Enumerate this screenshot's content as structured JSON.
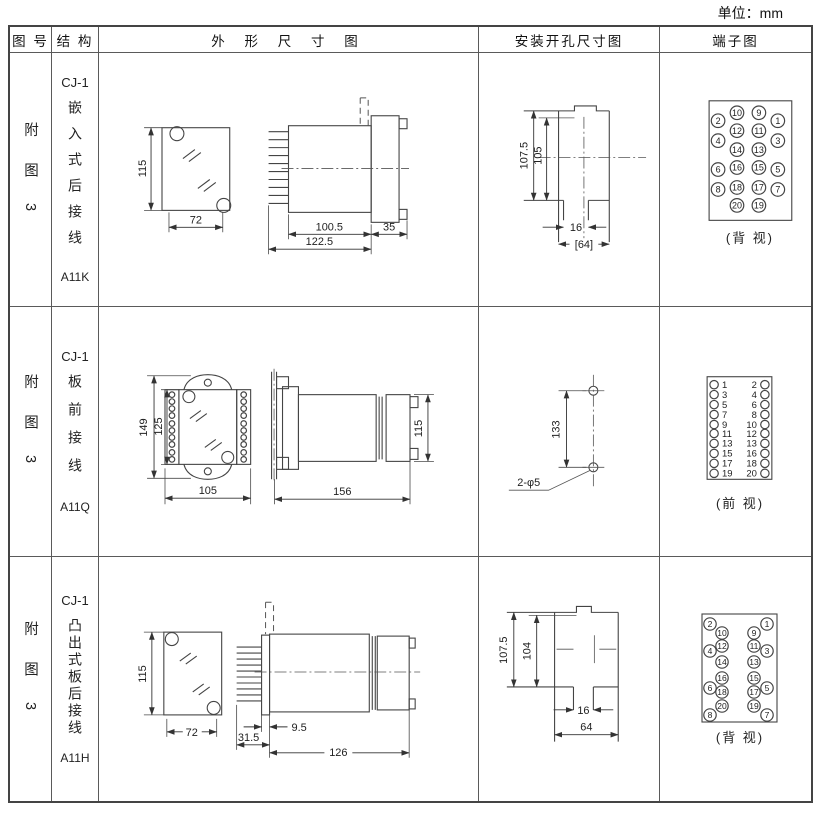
{
  "unit_label": "单位：mm",
  "headers": {
    "figure": "图 号",
    "structure": "结 构",
    "outline": "外 形 尺 寸 图",
    "install": "安装开孔尺寸图",
    "terminal": "端子图"
  },
  "rows": [
    {
      "figure": "附图3",
      "model": "CJ-1",
      "mounting": "嵌入式后接线",
      "code": "A11K",
      "outline": {
        "height": "115",
        "width": "72",
        "d1": "100.5",
        "d2": "122.5",
        "d3": "35"
      },
      "install": {
        "v1": "107.5",
        "v2": "105",
        "notch": "16",
        "span": "[64]"
      },
      "terminal": {
        "view": "(背 视)"
      }
    },
    {
      "figure": "附图3",
      "model": "CJ-1",
      "mounting": "板前接线",
      "code": "A11Q",
      "outline": {
        "h1": "149",
        "h2": "125",
        "width": "105",
        "length": "156",
        "rear_h": "115"
      },
      "install": {
        "span": "133",
        "holes": "2-φ5"
      },
      "terminal": {
        "view": "(前 视)"
      }
    },
    {
      "figure": "附图3",
      "model": "CJ-1",
      "mounting": "凸出式板后接线",
      "code": "A11H",
      "outline": {
        "height": "115",
        "width": "72",
        "d1": "9.5",
        "d2": "31.5",
        "d3": "126"
      },
      "install": {
        "v1": "107.5",
        "v2": "104",
        "notch": "16",
        "span": "64"
      },
      "terminal": {
        "view": "(背 视)"
      }
    }
  ],
  "terminals": {
    "a11k": {
      "r": 6.8,
      "font": 9,
      "dy": 3.2,
      "items": [
        {
          "n": "10",
          "cx": 77,
          "cy": 60
        },
        {
          "n": "9",
          "cx": 99,
          "cy": 60
        },
        {
          "n": "2",
          "cx": 58,
          "cy": 68
        },
        {
          "n": "1",
          "cx": 118,
          "cy": 68
        },
        {
          "n": "12",
          "cx": 77,
          "cy": 78
        },
        {
          "n": "11",
          "cx": 99,
          "cy": 78
        },
        {
          "n": "4",
          "cx": 58,
          "cy": 88
        },
        {
          "n": "3",
          "cx": 118,
          "cy": 88
        },
        {
          "n": "14",
          "cx": 77,
          "cy": 97
        },
        {
          "n": "13",
          "cx": 99,
          "cy": 97
        },
        {
          "n": "16",
          "cx": 77,
          "cy": 115
        },
        {
          "n": "15",
          "cx": 99,
          "cy": 115
        },
        {
          "n": "6",
          "cx": 58,
          "cy": 117
        },
        {
          "n": "5",
          "cx": 118,
          "cy": 117
        },
        {
          "n": "18",
          "cx": 77,
          "cy": 135
        },
        {
          "n": "17",
          "cx": 99,
          "cy": 135
        },
        {
          "n": "8",
          "cx": 58,
          "cy": 137
        },
        {
          "n": "7",
          "cx": 118,
          "cy": 137
        },
        {
          "n": "20",
          "cx": 77,
          "cy": 153
        },
        {
          "n": "19",
          "cx": 99,
          "cy": 153
        }
      ]
    },
    "a11q": {
      "r": 4.2,
      "font": 9.5,
      "dy": 3.3,
      "items": [
        {
          "n": "1",
          "cx": 54,
          "cy": 78,
          "tx": 62,
          "anchor": "start"
        },
        {
          "n": "2",
          "cx": 105,
          "cy": 78,
          "tx": 97,
          "anchor": "end"
        },
        {
          "n": "3",
          "cx": 54,
          "cy": 88,
          "tx": 62,
          "anchor": "start"
        },
        {
          "n": "4",
          "cx": 105,
          "cy": 88,
          "tx": 97,
          "anchor": "end"
        },
        {
          "n": "5",
          "cx": 54,
          "cy": 98,
          "tx": 62,
          "anchor": "start"
        },
        {
          "n": "6",
          "cx": 105,
          "cy": 98,
          "tx": 97,
          "anchor": "end"
        },
        {
          "n": "7",
          "cx": 54,
          "cy": 108,
          "tx": 62,
          "anchor": "start"
        },
        {
          "n": "8",
          "cx": 105,
          "cy": 108,
          "tx": 97,
          "anchor": "end"
        },
        {
          "n": "9",
          "cx": 54,
          "cy": 118,
          "tx": 62,
          "anchor": "start"
        },
        {
          "n": "10",
          "cx": 105,
          "cy": 118,
          "tx": 97,
          "anchor": "end"
        },
        {
          "n": "11",
          "cx": 54,
          "cy": 127,
          "tx": 62,
          "anchor": "start"
        },
        {
          "n": "12",
          "cx": 105,
          "cy": 127,
          "tx": 97,
          "anchor": "end"
        },
        {
          "n": "13",
          "cx": 54,
          "cy": 137,
          "tx": 62,
          "anchor": "start"
        },
        {
          "n": "13",
          "cx": 105,
          "cy": 137,
          "tx": 97,
          "anchor": "end"
        },
        {
          "n": "15",
          "cx": 54,
          "cy": 147,
          "tx": 62,
          "anchor": "start"
        },
        {
          "n": "16",
          "cx": 105,
          "cy": 147,
          "tx": 97,
          "anchor": "end"
        },
        {
          "n": "17",
          "cx": 54,
          "cy": 157,
          "tx": 62,
          "anchor": "start"
        },
        {
          "n": "18",
          "cx": 105,
          "cy": 157,
          "tx": 97,
          "anchor": "end"
        },
        {
          "n": "19",
          "cx": 54,
          "cy": 167,
          "tx": 62,
          "anchor": "start"
        },
        {
          "n": "20",
          "cx": 105,
          "cy": 167,
          "tx": 97,
          "anchor": "end"
        }
      ]
    },
    "a11q_strip": {
      "r": 2.8,
      "items": [
        {
          "cx": 73,
          "cy": 88
        },
        {
          "cx": 73,
          "cy": 95
        },
        {
          "cx": 73,
          "cy": 102
        },
        {
          "cx": 73,
          "cy": 109
        },
        {
          "cx": 73,
          "cy": 117
        },
        {
          "cx": 73,
          "cy": 124
        },
        {
          "cx": 73,
          "cy": 131
        },
        {
          "cx": 73,
          "cy": 138
        },
        {
          "cx": 73,
          "cy": 146
        },
        {
          "cx": 73,
          "cy": 153
        },
        {
          "cx": 145,
          "cy": 88
        },
        {
          "cx": 145,
          "cy": 95
        },
        {
          "cx": 145,
          "cy": 102
        },
        {
          "cx": 145,
          "cy": 109
        },
        {
          "cx": 145,
          "cy": 117
        },
        {
          "cx": 145,
          "cy": 124
        },
        {
          "cx": 145,
          "cy": 131
        },
        {
          "cx": 145,
          "cy": 138
        },
        {
          "cx": 145,
          "cy": 146
        },
        {
          "cx": 145,
          "cy": 153
        }
      ]
    },
    "a11h": {
      "r": 6.2,
      "font": 8.5,
      "dy": 3,
      "items": [
        {
          "n": "2",
          "cx": 50,
          "cy": 67
        },
        {
          "n": "1",
          "cx": 107,
          "cy": 67
        },
        {
          "n": "10",
          "cx": 62,
          "cy": 76
        },
        {
          "n": "9",
          "cx": 94,
          "cy": 76
        },
        {
          "n": "12",
          "cx": 62,
          "cy": 89
        },
        {
          "n": "11",
          "cx": 94,
          "cy": 89
        },
        {
          "n": "4",
          "cx": 50,
          "cy": 94
        },
        {
          "n": "3",
          "cx": 107,
          "cy": 94
        },
        {
          "n": "14",
          "cx": 62,
          "cy": 105
        },
        {
          "n": "13",
          "cx": 94,
          "cy": 105
        },
        {
          "n": "16",
          "cx": 62,
          "cy": 121
        },
        {
          "n": "15",
          "cx": 94,
          "cy": 121
        },
        {
          "n": "6",
          "cx": 50,
          "cy": 131
        },
        {
          "n": "5",
          "cx": 107,
          "cy": 131
        },
        {
          "n": "18",
          "cx": 62,
          "cy": 135
        },
        {
          "n": "17",
          "cx": 94,
          "cy": 135
        },
        {
          "n": "20",
          "cx": 62,
          "cy": 149
        },
        {
          "n": "19",
          "cx": 94,
          "cy": 149
        },
        {
          "n": "8",
          "cx": 50,
          "cy": 158
        },
        {
          "n": "7",
          "cx": 107,
          "cy": 158
        }
      ]
    }
  }
}
